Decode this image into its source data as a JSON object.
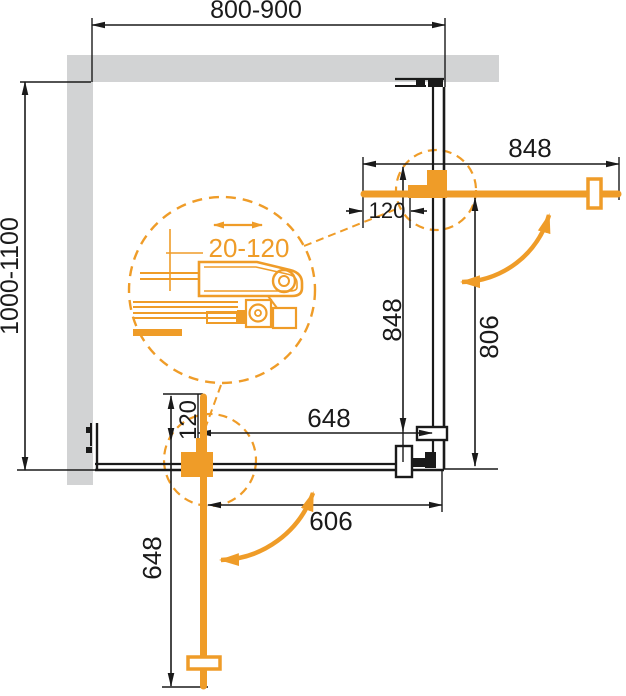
{
  "drawing": {
    "type": "shower-enclosure-corner-plan-technical-drawing",
    "colors": {
      "accent_orange": "#EF9C28",
      "wall_gray": "#D2D3D4",
      "ink": "#1A1A1A",
      "bg": "#FFFFFF"
    },
    "dimensions": {
      "top_width": "800-900",
      "left_height": "1000-1100",
      "right_door_width": "848",
      "right_door_offset": "120",
      "side_panel_length": "848",
      "right_opening_height": "806",
      "bottom_panel_width": "648",
      "bottom_opening_width": "606",
      "bottom_door_offset": "120",
      "bottom_door_length": "648",
      "detail_adjustment_range": "20-120"
    }
  }
}
